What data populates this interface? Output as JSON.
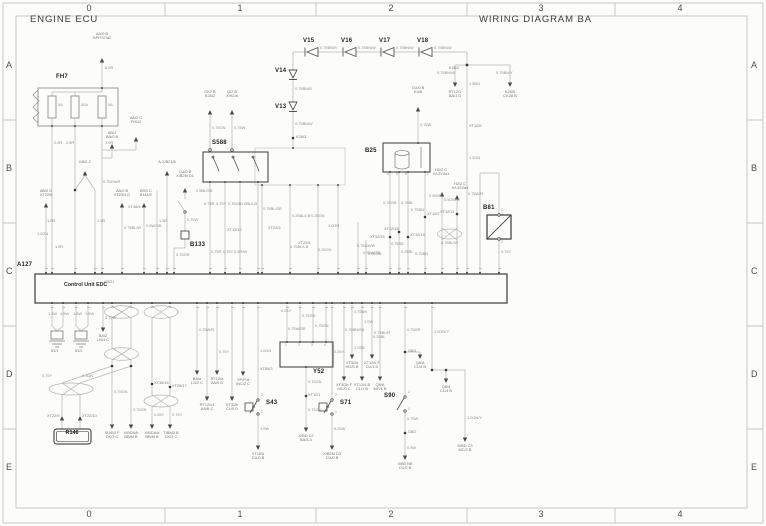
{
  "titles": {
    "left": "ENGINE ECU",
    "right": "WIRING DIAGRAM BA"
  },
  "grid": {
    "cols": [
      "0",
      "1",
      "2",
      "3",
      "4"
    ],
    "col_centers": [
      89,
      240,
      391,
      541,
      680
    ],
    "rows": [
      "A",
      "B",
      "C",
      "D",
      "E"
    ],
    "row_centers": [
      60,
      163,
      266,
      369,
      462
    ]
  },
  "a127": {
    "ref": "A127",
    "label": "Control Unit EDC",
    "sup": "A30/31",
    "top_pins_x": [
      46,
      52,
      75,
      95,
      102,
      122,
      144,
      157,
      167,
      174,
      210,
      225,
      240,
      258,
      262,
      290,
      318,
      338,
      358,
      366,
      390,
      399,
      408,
      425,
      442,
      457,
      467,
      480,
      499
    ],
    "bottom_pins_x": [
      52,
      63,
      76,
      88,
      103,
      112,
      131,
      152,
      170,
      197,
      207,
      217,
      232,
      243,
      258,
      287,
      300,
      313,
      326,
      332,
      344,
      352,
      362,
      372,
      380,
      405,
      432
    ]
  },
  "colors": {
    "wire": "#b5b5b5",
    "dark": "#555555",
    "accent": "#444444",
    "frame": "#c4c4c4"
  },
  "texts": [
    {
      "t": "FH7",
      "x": 56,
      "y": 74,
      "c": "ref",
      "n": "component-ref-fh7"
    },
    {
      "t": "S588",
      "x": 212,
      "y": 140,
      "c": "ref",
      "n": "component-ref-s588"
    },
    {
      "t": "B25",
      "x": 365,
      "y": 148,
      "c": "ref",
      "n": "component-ref-b25"
    },
    {
      "t": "B81",
      "x": 483,
      "y": 205,
      "c": "ref",
      "n": "component-ref-b81"
    },
    {
      "t": "A127",
      "x": 17,
      "y": 262,
      "c": "ref",
      "n": "component-ref-a127"
    },
    {
      "t": "Y52",
      "x": 313,
      "y": 369,
      "c": "ref",
      "n": "component-ref-y52"
    },
    {
      "t": "S43",
      "x": 266,
      "y": 400,
      "c": "ref",
      "n": "component-ref-s43"
    },
    {
      "t": "S71",
      "x": 340,
      "y": 400,
      "c": "ref",
      "n": "component-ref-s71"
    },
    {
      "t": "S90",
      "x": 384,
      "y": 393,
      "c": "ref",
      "n": "component-ref-s90"
    },
    {
      "t": "B133",
      "x": 190,
      "y": 242,
      "c": "ref",
      "n": "component-ref-b133"
    },
    {
      "t": "V13",
      "x": 275,
      "y": 104,
      "c": "ref",
      "n": "component-ref-v13"
    },
    {
      "t": "V14",
      "x": 275,
      "y": 68,
      "c": "ref",
      "n": "component-ref-v14"
    },
    {
      "t": "V15",
      "x": 303,
      "y": 38,
      "c": "ref",
      "n": "component-ref-v15"
    },
    {
      "t": "V16",
      "x": 341,
      "y": 38,
      "c": "ref",
      "n": "component-ref-v16"
    },
    {
      "t": "V17",
      "x": 379,
      "y": 38,
      "c": "ref",
      "n": "component-ref-v17"
    },
    {
      "t": "V18",
      "x": 417,
      "y": 38,
      "c": "ref",
      "n": "component-ref-v18"
    },
    {
      "t": "R146",
      "x": 72,
      "y": 431,
      "c": "r146",
      "n": "component-ref-r146"
    },
    {
      "t": "Control Unit EDC",
      "x": 64,
      "y": 283,
      "c": "ecu",
      "n": "control-unit-label"
    },
    {
      "t": "A30/31",
      "x": 104,
      "y": 281,
      "c": "sup",
      "n": "control-unit-sup"
    },
    {
      "t": "5A",
      "x": 58,
      "y": 103,
      "c": "fuse"
    },
    {
      "t": "30A",
      "x": 81,
      "y": 103,
      "c": "fuse"
    },
    {
      "t": "5A",
      "x": 108,
      "y": 103,
      "c": "fuse"
    },
    {
      "t": "6.0R",
      "x": 105,
      "y": 66,
      "c": "w"
    },
    {
      "t": "1.0R",
      "x": 105,
      "y": 141,
      "c": "w"
    },
    {
      "t": "2.5R",
      "x": 54,
      "y": 141,
      "c": "w"
    },
    {
      "t": "2.5R",
      "x": 66,
      "y": 141,
      "c": "w"
    },
    {
      "t": "1.5R",
      "x": 47,
      "y": 219,
      "c": "w"
    },
    {
      "t": "1.5R",
      "x": 97,
      "y": 219,
      "c": "w"
    },
    {
      "t": "1.5R",
      "x": 55,
      "y": 245,
      "c": "w"
    },
    {
      "t": "1.5R",
      "x": 159,
      "y": 219,
      "c": "w"
    },
    {
      "t": "1.0GN",
      "x": 37,
      "y": 232,
      "c": "w"
    },
    {
      "t": "0.75GN/R",
      "x": 103,
      "y": 180,
      "c": "w"
    },
    {
      "t": "0.75BL/W",
      "x": 124,
      "y": 226,
      "c": "w"
    },
    {
      "t": "0.5W/SB",
      "x": 146,
      "y": 224,
      "c": "w"
    },
    {
      "t": "0.75GR",
      "x": 176,
      "y": 253,
      "c": "w"
    },
    {
      "t": "0.75W",
      "x": 187,
      "y": 218,
      "c": "w"
    },
    {
      "t": "0.5BL/SB",
      "x": 196,
      "y": 189,
      "c": "w"
    },
    {
      "t": "0.75GN",
      "x": 212,
      "y": 126,
      "c": "w"
    },
    {
      "t": "0.75W",
      "x": 234,
      "y": 126,
      "c": "w"
    },
    {
      "t": "0.75R",
      "x": 204,
      "y": 202,
      "c": "w"
    },
    {
      "t": "0.75Y",
      "x": 216,
      "y": 202,
      "c": "w"
    },
    {
      "t": "0.75GB",
      "x": 228,
      "y": 202,
      "c": "w"
    },
    {
      "t": "1.0BL/LB",
      "x": 241,
      "y": 202,
      "c": "w"
    },
    {
      "t": "0.75R",
      "x": 211,
      "y": 250,
      "c": "w"
    },
    {
      "t": "0.75Y",
      "x": 223,
      "y": 250,
      "c": "w"
    },
    {
      "t": "0.5R/W",
      "x": 234,
      "y": 250,
      "c": "w"
    },
    {
      "t": "0.75BL/SB",
      "x": 263,
      "y": 207,
      "c": "w"
    },
    {
      "t": "0.25BL/LB",
      "x": 292,
      "y": 214,
      "c": "w"
    },
    {
      "t": "0.25GN",
      "x": 311,
      "y": 214,
      "c": "w"
    },
    {
      "t": "1.0GN",
      "x": 328,
      "y": 224,
      "c": "w"
    },
    {
      "t": "0.25GN",
      "x": 318,
      "y": 248,
      "c": "w"
    },
    {
      "t": "0.75BL/LB",
      "x": 290,
      "y": 245,
      "c": "w"
    },
    {
      "t": "0.75BN/R",
      "x": 320,
      "y": 46,
      "c": "w"
    },
    {
      "t": "0.75BN/W",
      "x": 358,
      "y": 46,
      "c": "w"
    },
    {
      "t": "0.75BN/W",
      "x": 396,
      "y": 46,
      "c": "w"
    },
    {
      "t": "0.75BN/W",
      "x": 434,
      "y": 46,
      "c": "w"
    },
    {
      "t": "0.75BN/R",
      "x": 295,
      "y": 87,
      "c": "w"
    },
    {
      "t": "0.75BN/W",
      "x": 295,
      "y": 122,
      "c": "w"
    },
    {
      "t": "0.75BN/W",
      "x": 437,
      "y": 71,
      "c": "w"
    },
    {
      "t": "0.75BN/Y",
      "x": 496,
      "y": 71,
      "c": "w"
    },
    {
      "t": "1.5BN",
      "x": 469,
      "y": 82,
      "c": "w"
    },
    {
      "t": "1.5GN",
      "x": 469,
      "y": 156,
      "c": "w"
    },
    {
      "t": "0.75W",
      "x": 420,
      "y": 123,
      "c": "w"
    },
    {
      "t": "0.75GR",
      "x": 383,
      "y": 201,
      "c": "w"
    },
    {
      "t": "0.75BL",
      "x": 401,
      "y": 201,
      "c": "w"
    },
    {
      "t": "0.75BN",
      "x": 411,
      "y": 208,
      "c": "w"
    },
    {
      "t": "0.75W/SB",
      "x": 363,
      "y": 251,
      "c": "w"
    },
    {
      "t": "0.75SB",
      "x": 391,
      "y": 242,
      "c": "w"
    },
    {
      "t": "0.25BL",
      "x": 401,
      "y": 250,
      "c": "w"
    },
    {
      "t": "0.75BN",
      "x": 415,
      "y": 252,
      "c": "w"
    },
    {
      "t": "0.5W/R",
      "x": 429,
      "y": 194,
      "c": "w"
    },
    {
      "t": "0.5GN/W",
      "x": 444,
      "y": 198,
      "c": "w"
    },
    {
      "t": "0.75BL/W",
      "x": 441,
      "y": 241,
      "c": "w"
    },
    {
      "t": "0.75W/R",
      "x": 468,
      "y": 192,
      "c": "w"
    },
    {
      "t": "0.75Y",
      "x": 501,
      "y": 250,
      "c": "w"
    },
    {
      "t": "1.5W",
      "x": 48,
      "y": 312,
      "c": "w"
    },
    {
      "t": "1.5W",
      "x": 60,
      "y": 312,
      "c": "w"
    },
    {
      "t": "1.5W",
      "x": 73,
      "y": 312,
      "c": "w"
    },
    {
      "t": "1.5W",
      "x": 85,
      "y": 312,
      "c": "w"
    },
    {
      "t": "0.75W",
      "x": 105,
      "y": 316,
      "c": "w"
    },
    {
      "t": "0.75Y",
      "x": 42,
      "y": 374,
      "c": "w"
    },
    {
      "t": "0.5GN",
      "x": 82,
      "y": 374,
      "c": "w"
    },
    {
      "t": "0.75GN",
      "x": 114,
      "y": 390,
      "c": "w"
    },
    {
      "t": "0.75GN",
      "x": 133,
      "y": 408,
      "c": "w"
    },
    {
      "t": "0.25Y",
      "x": 154,
      "y": 413,
      "c": "w"
    },
    {
      "t": "0.75Y",
      "x": 172,
      "y": 413,
      "c": "w"
    },
    {
      "t": "0.75Y",
      "x": 219,
      "y": 350,
      "c": "w"
    },
    {
      "t": "0.75W/R",
      "x": 199,
      "y": 328,
      "c": "w"
    },
    {
      "t": "0.25Y",
      "x": 281,
      "y": 309,
      "c": "w"
    },
    {
      "t": "0.75GN",
      "x": 302,
      "y": 314,
      "c": "w"
    },
    {
      "t": "0.75W/SB",
      "x": 288,
      "y": 327,
      "c": "w"
    },
    {
      "t": "0.75GN",
      "x": 315,
      "y": 324,
      "c": "w"
    },
    {
      "t": "0.75GN",
      "x": 308,
      "y": 380,
      "c": "w"
    },
    {
      "t": "0.75GN",
      "x": 308,
      "y": 408,
      "c": "w"
    },
    {
      "t": "1.0GN",
      "x": 260,
      "y": 349,
      "c": "w"
    },
    {
      "t": "1.0W",
      "x": 260,
      "y": 427,
      "c": "w"
    },
    {
      "t": "0.25Y",
      "x": 334,
      "y": 350,
      "c": "w"
    },
    {
      "t": "0.25W",
      "x": 334,
      "y": 427,
      "c": "w"
    },
    {
      "t": "0.75BN/SB",
      "x": 345,
      "y": 328,
      "c": "w"
    },
    {
      "t": "0.75BN",
      "x": 354,
      "y": 310,
      "c": "w"
    },
    {
      "t": "1.0W",
      "x": 364,
      "y": 320,
      "c": "w"
    },
    {
      "t": "0.25BL",
      "x": 373,
      "y": 335,
      "c": "w"
    },
    {
      "t": "1.0SB",
      "x": 354,
      "y": 346,
      "c": "w"
    },
    {
      "t": "0.75BL/R",
      "x": 374,
      "y": 331,
      "c": "w"
    },
    {
      "t": "0.75GR",
      "x": 407,
      "y": 328,
      "c": "w"
    },
    {
      "t": "0.75W",
      "x": 407,
      "y": 417,
      "c": "w"
    },
    {
      "t": "0.5W",
      "x": 407,
      "y": 446,
      "c": "w"
    },
    {
      "t": "1.5GN/Y",
      "x": 434,
      "y": 330,
      "c": "w"
    },
    {
      "t": "1.0GN/Y",
      "x": 467,
      "y": 416,
      "c": "w"
    },
    {
      "t": "0.75GN/W",
      "x": 357,
      "y": 244,
      "c": "w"
    },
    {
      "t": "0.25GN",
      "x": 368,
      "y": 252,
      "c": "w"
    },
    {
      "t": "K28/3",
      "x": 296,
      "y": 135,
      "c": "j"
    },
    {
      "t": "K28/2",
      "x": 449,
      "y": 66,
      "c": "j"
    },
    {
      "t": "XT12/6",
      "x": 469,
      "y": 124,
      "c": "j"
    },
    {
      "t": "XT12/12",
      "x": 227,
      "y": 228,
      "c": "j"
    },
    {
      "t": "XT22/3",
      "x": 268,
      "y": 226,
      "c": "j"
    },
    {
      "t": "XT22/4",
      "x": 298,
      "y": 241,
      "c": "j"
    },
    {
      "t": "XT12/15",
      "x": 370,
      "y": 235,
      "c": "j"
    },
    {
      "t": "XT12/16",
      "x": 384,
      "y": 227,
      "c": "j"
    },
    {
      "t": "XT12/14",
      "x": 410,
      "y": 233,
      "c": "j"
    },
    {
      "t": "XT12/2",
      "x": 427,
      "y": 212,
      "c": "j"
    },
    {
      "t": "XT12/11",
      "x": 440,
      "y": 210,
      "c": "j"
    },
    {
      "t": "XT16/4",
      "x": 128,
      "y": 205,
      "c": "j"
    },
    {
      "t": "XT35/16",
      "x": 154,
      "y": 381,
      "c": "j"
    },
    {
      "t": "XT26/17",
      "x": 172,
      "y": 384,
      "c": "j"
    },
    {
      "t": "XT22/9",
      "x": 47,
      "y": 414,
      "c": "j"
    },
    {
      "t": "XT22/10",
      "x": 82,
      "y": 414,
      "c": "j"
    },
    {
      "t": "XT12/1",
      "x": 308,
      "y": 393,
      "c": "j"
    },
    {
      "t": "XT55/3",
      "x": 260,
      "y": 367,
      "c": "j"
    },
    {
      "t": "G8/1",
      "x": 408,
      "y": 349,
      "c": "j"
    },
    {
      "t": "G8/2",
      "x": 408,
      "y": 430,
      "c": "j"
    },
    {
      "t": "53/1",
      "x": 51,
      "y": 349,
      "c": "j"
    },
    {
      "t": "53/2",
      "x": 75,
      "y": 349,
      "c": "j"
    },
    {
      "t": "2",
      "x": 261,
      "y": 394,
      "c": "pn"
    },
    {
      "t": "1",
      "x": 261,
      "y": 411,
      "c": "pn"
    },
    {
      "t": "2",
      "x": 335,
      "y": 394,
      "c": "pn"
    },
    {
      "t": "1",
      "x": 335,
      "y": 411,
      "c": "pn"
    },
    {
      "t": "2",
      "x": 408,
      "y": 391,
      "c": "pn"
    },
    {
      "t": "1",
      "x": 408,
      "y": 408,
      "c": "pn"
    },
    {
      "t": "1",
      "x": 501,
      "y": 209,
      "c": "pn"
    },
    {
      "t": "2",
      "x": 501,
      "y": 241,
      "c": "pn"
    },
    {
      "t": "1",
      "x": 285,
      "y": 344,
      "c": "pn"
    },
    {
      "t": "2",
      "x": 298,
      "y": 344,
      "c": "pn"
    },
    {
      "t": "3",
      "x": 311,
      "y": 344,
      "c": "pn"
    },
    {
      "t": "4",
      "x": 324,
      "y": 344,
      "c": "pn"
    },
    {
      "t": "4",
      "x": 387,
      "y": 173,
      "c": "pn"
    },
    {
      "t": "5",
      "x": 396,
      "y": 173,
      "c": "pn"
    },
    {
      "t": "6",
      "x": 405,
      "y": 173,
      "c": "pn"
    },
    {
      "t": "1",
      "x": 427,
      "y": 173,
      "c": "pn"
    },
    {
      "t": "AA/0 B\nX/RT37/a2",
      "x": 102,
      "y": 32,
      "c": "d"
    },
    {
      "t": "K8/2-2",
      "x": 85,
      "y": 160,
      "c": "d"
    },
    {
      "t": "A.X/B21/6",
      "x": 167,
      "y": 160,
      "c": "d"
    },
    {
      "t": "AA/2 C\nFH1/2",
      "x": 136,
      "y": 116,
      "c": "d"
    },
    {
      "t": "6B/J\nBA/0 B",
      "x": 112,
      "y": 131,
      "c": "d"
    },
    {
      "t": "AB/2 D\nXT22/5",
      "x": 46,
      "y": 189,
      "c": "d"
    },
    {
      "t": "AA/2 B\nXT23/4 D",
      "x": 122,
      "y": 189,
      "c": "d"
    },
    {
      "t": "B0/1 C\n8144/2",
      "x": 146,
      "y": 189,
      "c": "d"
    },
    {
      "t": "CU/0 B\nX/B2M D1",
      "x": 185,
      "y": 170,
      "c": "d"
    },
    {
      "t": "CK2 B\nK28/2",
      "x": 210,
      "y": 90,
      "c": "d"
    },
    {
      "t": "Q/2 B\nX/K2/a",
      "x": 232,
      "y": 90,
      "c": "d"
    },
    {
      "t": "CU/0 B\nK4/8",
      "x": 418,
      "y": 86,
      "c": "d"
    },
    {
      "t": "RT12/1\nBA/1 D",
      "x": 455,
      "y": 90,
      "c": "d"
    },
    {
      "t": "K28/5\nCK28 B",
      "x": 510,
      "y": 90,
      "c": "d"
    },
    {
      "t": "H2/2 C\nX/LED/a1",
      "x": 441,
      "y": 168,
      "c": "d"
    },
    {
      "t": "H2/2 C\nX/LED/a4",
      "x": 460,
      "y": 182,
      "c": "d"
    },
    {
      "t": "BA/2\nLN/1 C",
      "x": 103,
      "y": 334,
      "c": "d"
    },
    {
      "t": "SU/B3 F\nCK/3 C",
      "x": 112,
      "y": 431,
      "c": "d"
    },
    {
      "t": "X/BDA/b\nBB/M B",
      "x": 131,
      "y": 431,
      "c": "d"
    },
    {
      "t": "X/BDA/d\nBB/M B",
      "x": 152,
      "y": 431,
      "c": "d"
    },
    {
      "t": "T/BM3 B\nCK/2 C",
      "x": 171,
      "y": 431,
      "c": "d"
    },
    {
      "t": "BA/d\nLS/2 C",
      "x": 197,
      "y": 377,
      "c": "d"
    },
    {
      "t": "RT12/d\nAA/0 D",
      "x": 217,
      "y": 377,
      "c": "d"
    },
    {
      "t": "RT12/c3\nAA/B C",
      "x": 207,
      "y": 403,
      "c": "d"
    },
    {
      "t": "XT3/2b\nCL/0 D",
      "x": 232,
      "y": 403,
      "c": "d"
    },
    {
      "t": "YP/P/d\nINC/2 C",
      "x": 243,
      "y": 378,
      "c": "d"
    },
    {
      "t": "XT16/d\nCU/0 B",
      "x": 258,
      "y": 452,
      "c": "d"
    },
    {
      "t": "X/BD C2\nBA/3-4",
      "x": 306,
      "y": 434,
      "c": "d"
    },
    {
      "t": "X/B2M D3\nCU/0 B",
      "x": 332,
      "y": 452,
      "c": "d"
    },
    {
      "t": "XT3/2b F\nMC/0 C",
      "x": 344,
      "y": 383,
      "c": "d"
    },
    {
      "t": "XT12/4 B\nCL/1 B",
      "x": 362,
      "y": 383,
      "c": "d"
    },
    {
      "t": "Q8/A\nMC/1 B",
      "x": 380,
      "y": 383,
      "c": "d"
    },
    {
      "t": "XT3/2d\nHG/3 B",
      "x": 352,
      "y": 361,
      "c": "d"
    },
    {
      "t": "XT12/c F\nCU/1 D",
      "x": 372,
      "y": 361,
      "c": "d"
    },
    {
      "t": "Q8/A\nCL/4 B",
      "x": 420,
      "y": 361,
      "c": "d"
    },
    {
      "t": "Q8/d\nCL/4 B",
      "x": 446,
      "y": 385,
      "c": "d"
    },
    {
      "t": "X/B0 NB\nCU/2 B",
      "x": 405,
      "y": 462,
      "c": "d"
    },
    {
      "t": "X/BD C3\nMC/2 B",
      "x": 465,
      "y": 444,
      "c": "d"
    }
  ]
}
